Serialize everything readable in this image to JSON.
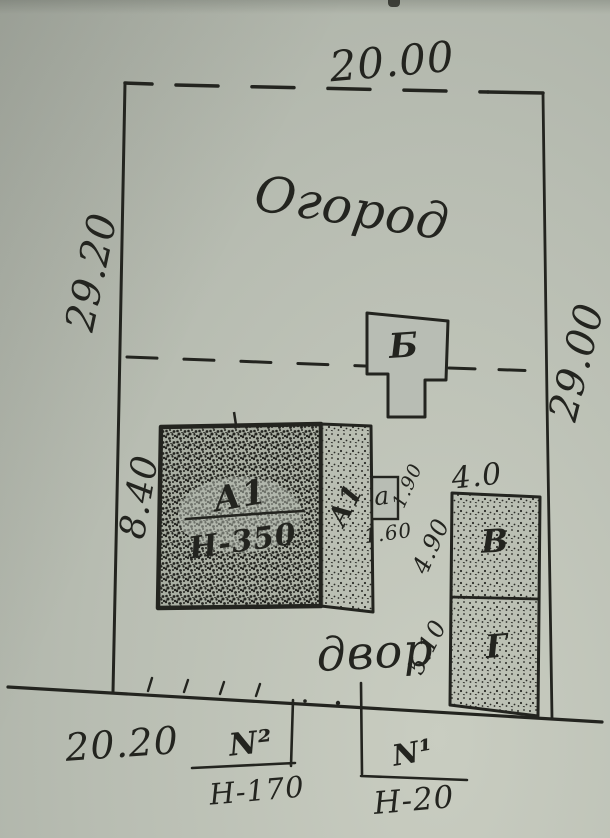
{
  "drawing": {
    "ink_color": "#23241f",
    "paper_color": "#b8bdb3",
    "areas": {
      "garden": "Огород",
      "yard": "двор"
    },
    "plot_dims": {
      "top": "20.00",
      "left": "29.20",
      "right": "29.00",
      "frontage": "20.20"
    },
    "buildings": {
      "main": {
        "label": "А1",
        "height": "Н-350",
        "side_dim": "8.40"
      },
      "annex": {
        "label": "А1"
      },
      "porch": {
        "label": "а",
        "dim_right": "1.90",
        "dim_bottom": "1.60"
      },
      "shed_b": {
        "label": "Б"
      },
      "shed_v": {
        "label": "В",
        "width_dim": "4.0"
      },
      "shed_g": {
        "label": "Г"
      },
      "gaps": {
        "porch_to_v": "4.90",
        "g_side": "5.10"
      }
    },
    "frontage_marks": {
      "n2": {
        "label": "N²",
        "height": "Н-170"
      },
      "n1": {
        "label": "N¹",
        "height": "Н-20"
      }
    }
  }
}
